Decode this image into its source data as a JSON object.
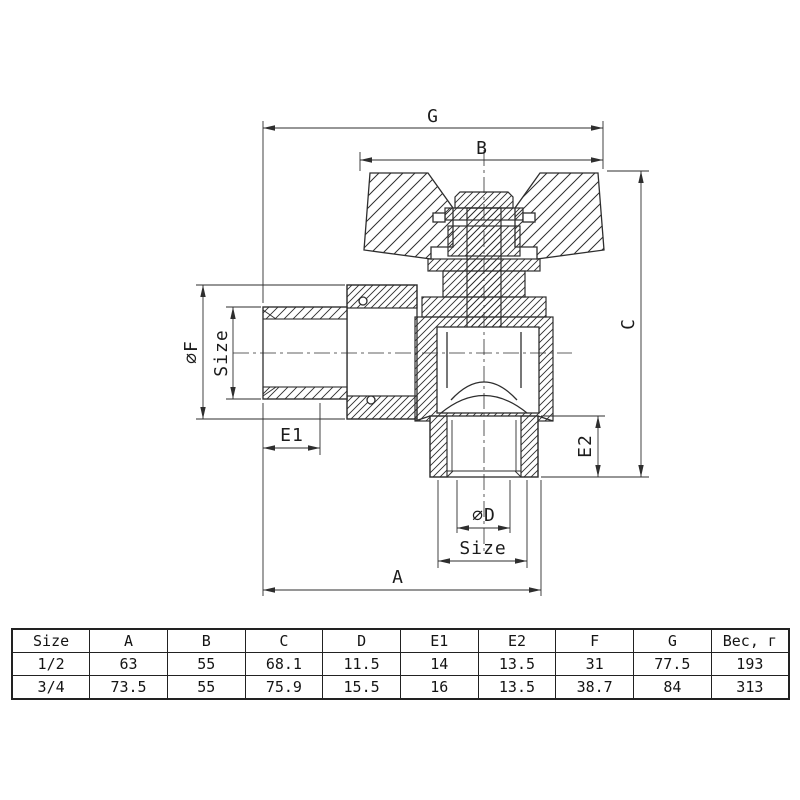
{
  "drawing": {
    "description": "Angle ball valve cross-section with butterfly handle",
    "line_color": "#2e2e2e",
    "dimensions": {
      "G": "G",
      "B": "B",
      "C": "C",
      "A": "A",
      "E1": "E1",
      "E2": "E2",
      "phiF": "∅F",
      "phiD": "∅D",
      "size_left": "Size",
      "size_bottom": "Size"
    }
  },
  "table": {
    "headers": [
      "Size",
      "A",
      "B",
      "C",
      "D",
      "E1",
      "E2",
      "F",
      "G",
      "Вес, г"
    ],
    "rows": [
      [
        "1/2",
        "63",
        "55",
        "68.1",
        "11.5",
        "14",
        "13.5",
        "31",
        "77.5",
        "193"
      ],
      [
        "3/4",
        "73.5",
        "55",
        "75.9",
        "15.5",
        "16",
        "13.5",
        "38.7",
        "84",
        "313"
      ]
    ]
  }
}
